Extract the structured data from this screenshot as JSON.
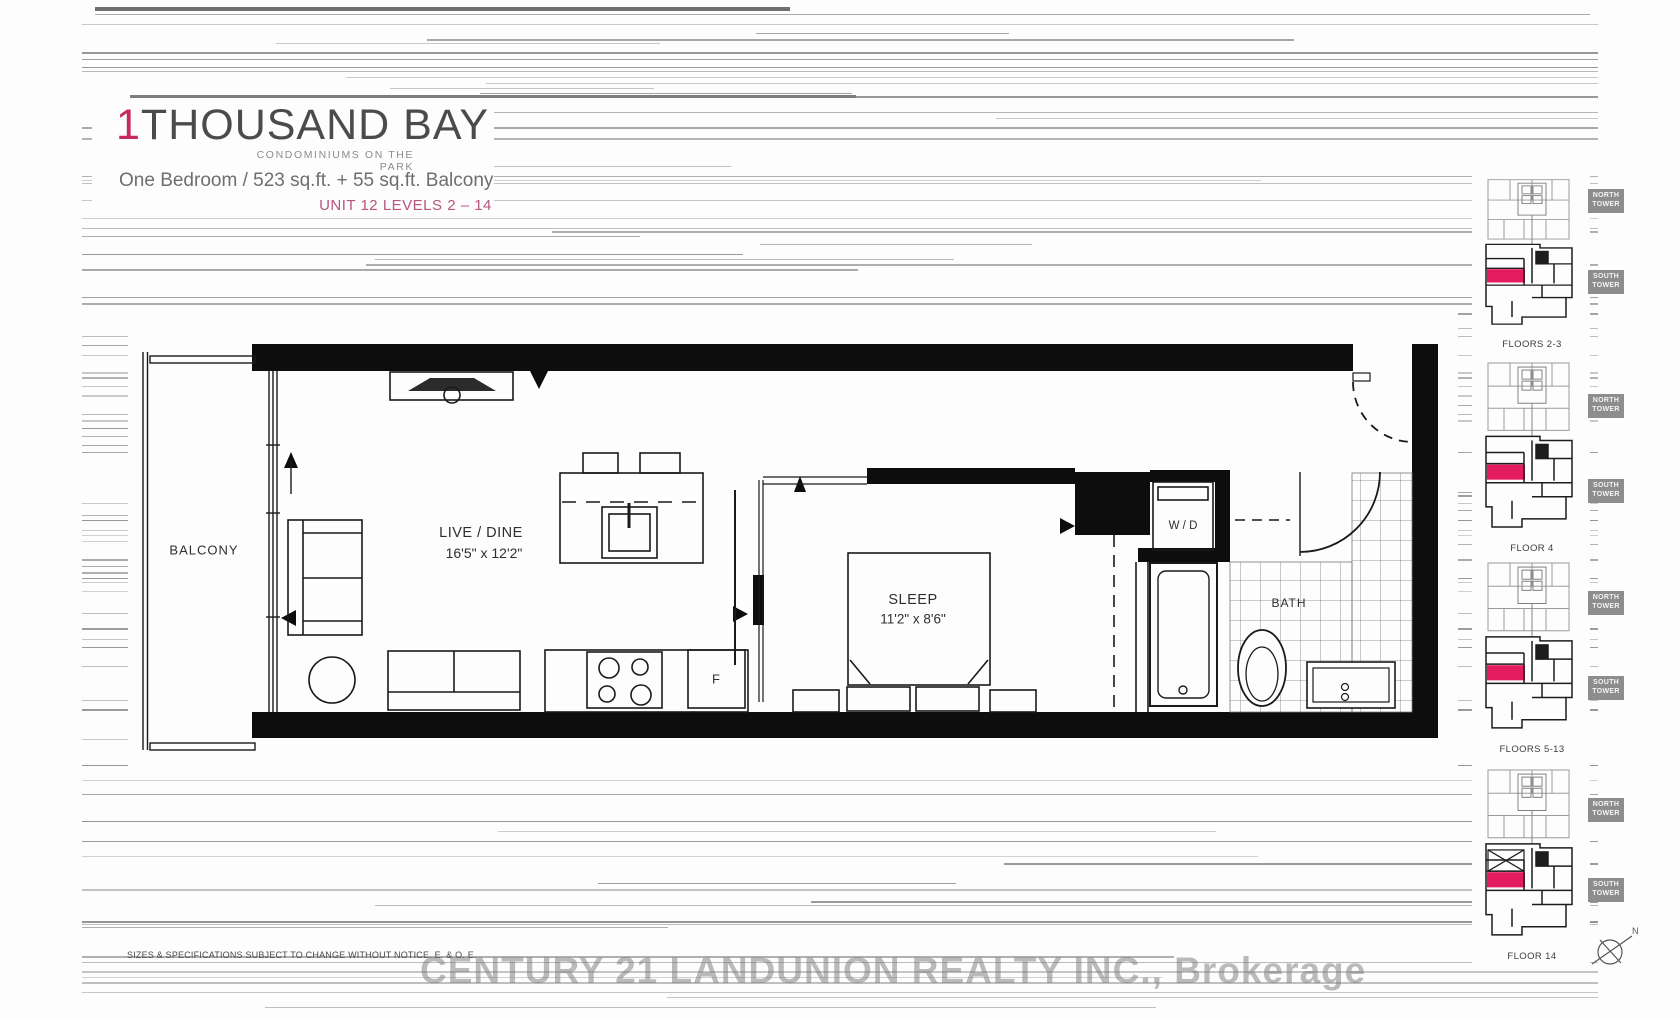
{
  "colors": {
    "brand_accent": "#c8295d",
    "unit_highlight": "#e31c5f",
    "unit_text": "#b8557f"
  },
  "header": {
    "logo_prefix": "1",
    "logo_name": "THOUSAND BAY",
    "tagline": "CONDOMINIUMS ON THE PARK",
    "spec_line": "One Bedroom / 523 sq.ft. + 55 sq.ft. Balcony",
    "unit_line": "UNIT 12 LEVELS 2 – 14"
  },
  "plan": {
    "balcony_label": "BALCONY",
    "live_dine_label": "LIVE / DINE",
    "live_dine_dims": "16'5\" x 12'2\"",
    "sleep_label": "SLEEP",
    "sleep_dims": "11'2\" x 8'6\"",
    "bath_label": "BATH",
    "washer_dryer_label": "W / D",
    "fridge_label": "F"
  },
  "keyplans": [
    {
      "label": "FLOORS 2-3",
      "north": "NORTH TOWER",
      "south": "SOUTH TOWER"
    },
    {
      "label": "FLOOR 4",
      "north": "NORTH TOWER",
      "south": "SOUTH TOWER"
    },
    {
      "label": "FLOORS 5-13",
      "north": "NORTH TOWER",
      "south": "SOUTH TOWER"
    },
    {
      "label": "FLOOR 14",
      "north": "NORTH TOWER",
      "south": "SOUTH TOWER"
    }
  ],
  "compass": {
    "north_label": "N"
  },
  "footer": {
    "disclaimer": "SIZES & SPECIFICATIONS SUBJECT TO CHANGE WITHOUT NOTICE. E. & O. E.",
    "watermark": "CENTURY 21 LANDUNION REALTY INC., Brokerage"
  }
}
